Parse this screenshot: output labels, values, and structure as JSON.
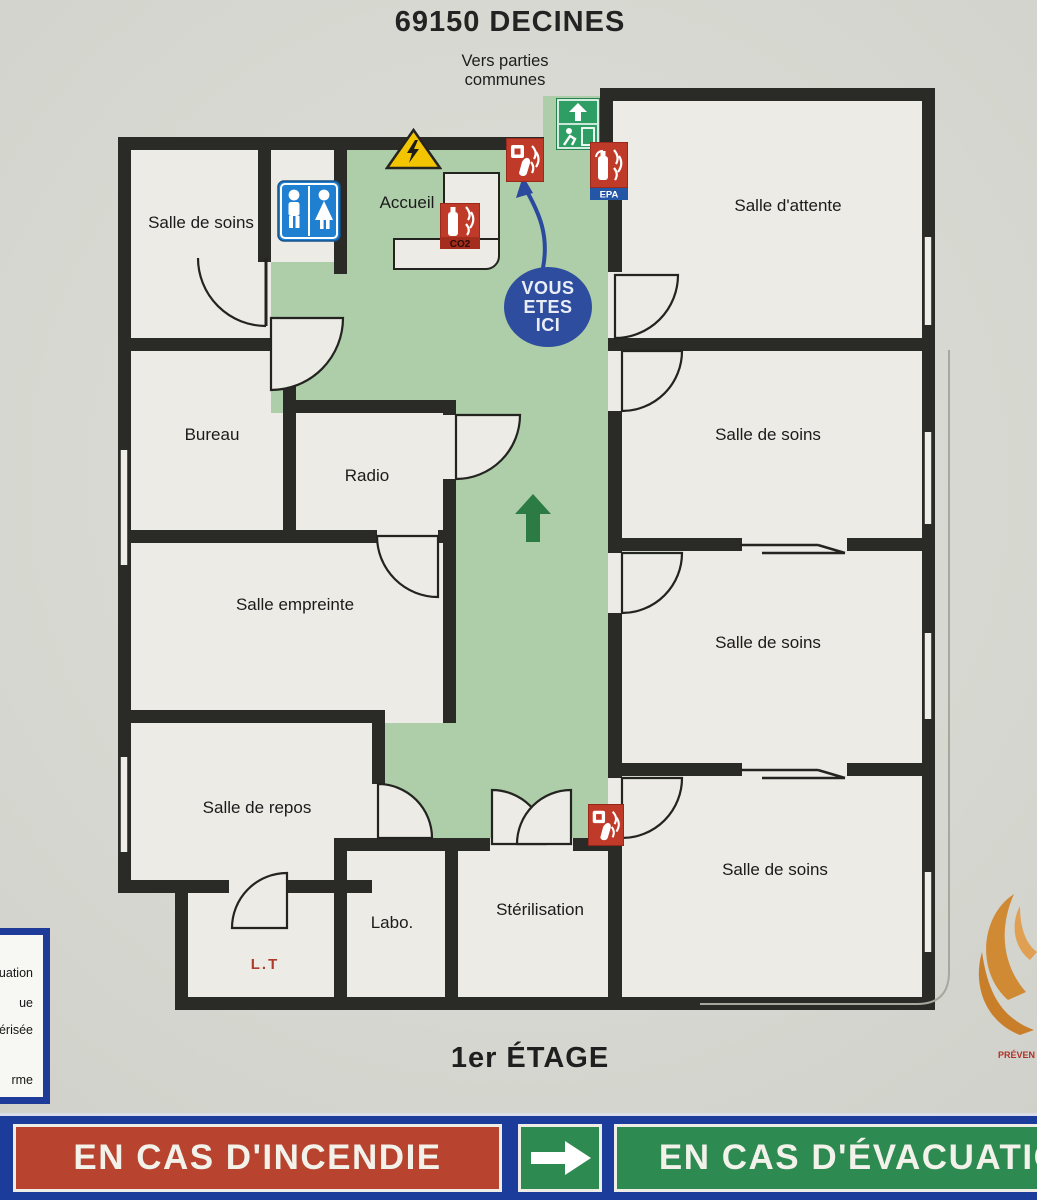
{
  "header": {
    "postcode_title": "69150 DECINES",
    "exit_note": "Vers parties communes"
  },
  "rooms": [
    {
      "label": "Salle de soins"
    },
    {
      "label": "Salle d'attente"
    },
    {
      "label": "Bureau"
    },
    {
      "label": "Radio"
    },
    {
      "label": "Salle empreinte"
    },
    {
      "label": "Salle de soins"
    },
    {
      "label": "Salle de soins"
    },
    {
      "label": "Salle de repos"
    },
    {
      "label": "Labo."
    },
    {
      "label": "Stérilisation"
    },
    {
      "label": "Salle de soins"
    },
    {
      "label": "Accueil"
    }
  ],
  "you_are_here": {
    "l1": "VOUS",
    "l2": "ETES",
    "l3": "ICI"
  },
  "markers": {
    "epa": "EPA",
    "co2": "CO2",
    "lt": "L.T"
  },
  "legend": {
    "fragments": [
      "'évacuation",
      "ue",
      "u pulvérisée",
      "rme"
    ]
  },
  "footer": {
    "floor": "1er ÉTAGE",
    "fire_banner": "EN CAS D'INCENDIE",
    "evac_banner": "EN CAS D'ÉVACUATION",
    "brand_fragment": "PRÉVEN"
  },
  "colors": {
    "corridor_green": "#aecda9",
    "wall": "#2a2a27",
    "banner_blue": "#1c3c9c",
    "fire_red": "#b8432f",
    "evac_green": "#2d8a50",
    "you_are_here_blue": "#2e4d9f",
    "safety_green": "#2f9e64",
    "hazard_yellow": "#f2c500",
    "extinguisher_red": "#bf3a28"
  }
}
